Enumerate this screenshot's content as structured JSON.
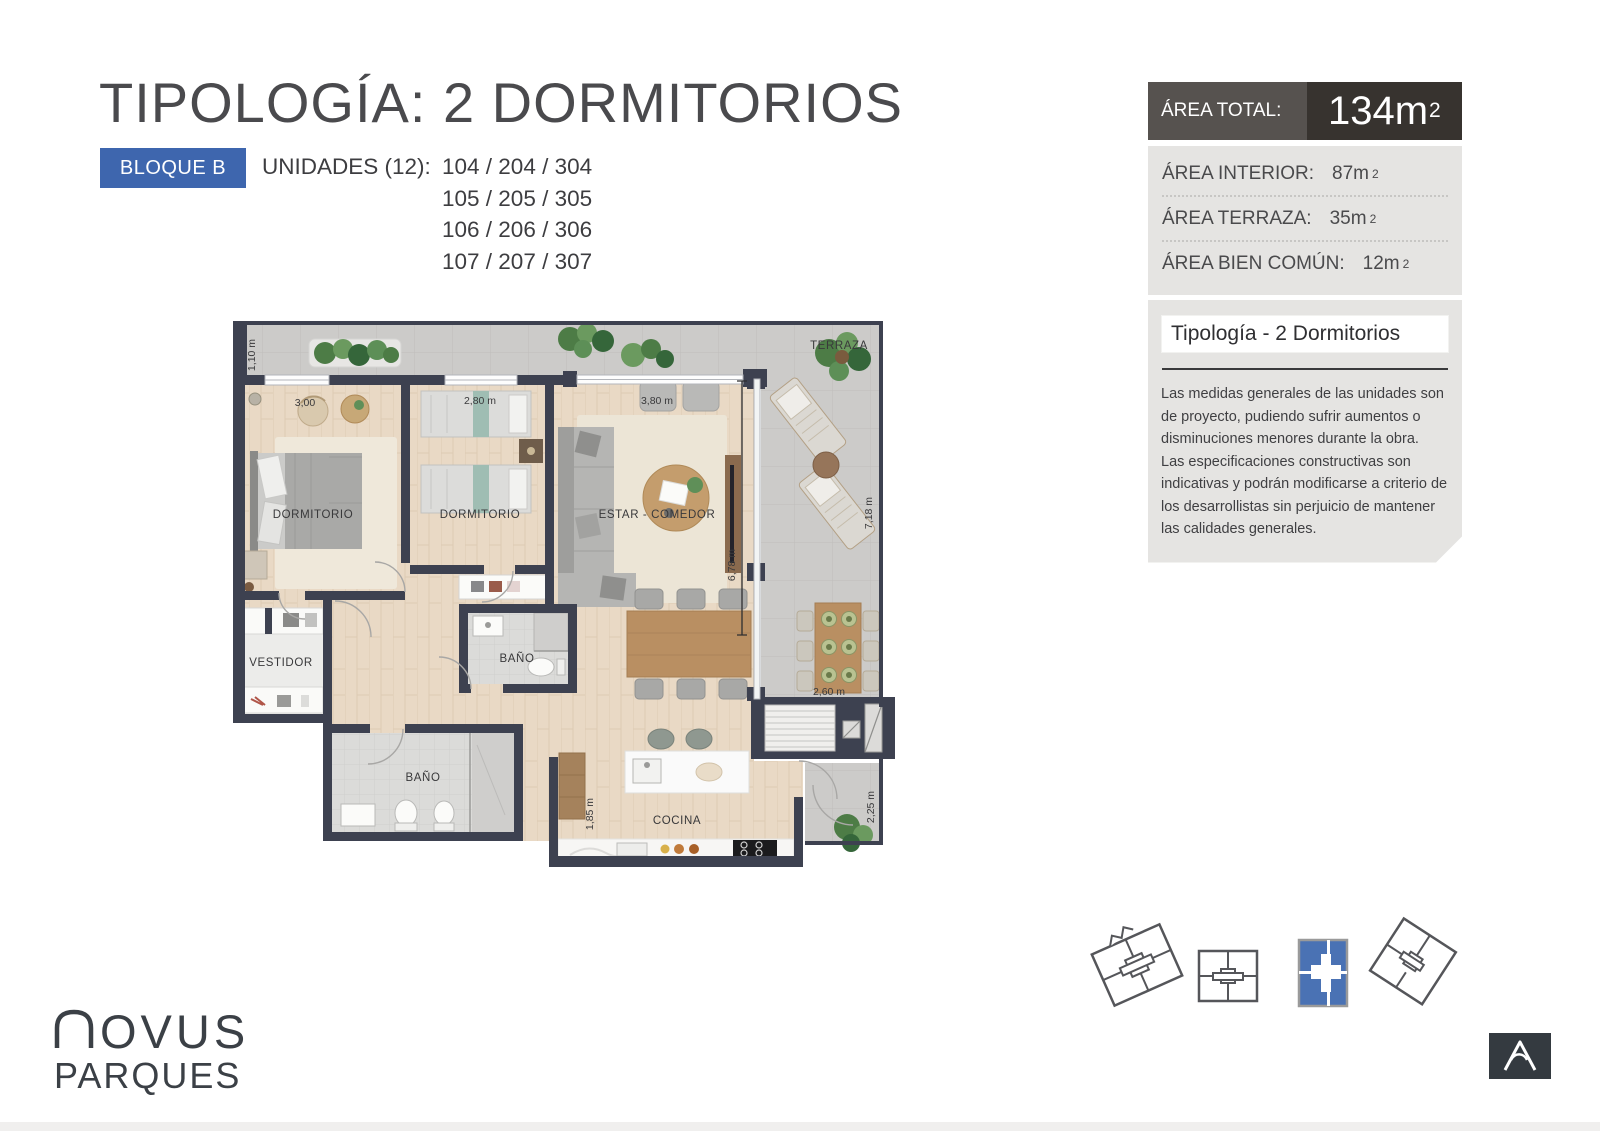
{
  "header": {
    "title": "TIPOLOGÍA: 2 DORMITORIOS",
    "block_badge": "BLOQUE B",
    "units_label": "UNIDADES (12):",
    "units_lines": [
      "104 / 204 / 304",
      "105 / 205 / 305",
      "106 / 206 / 306",
      "107 / 207 / 307"
    ]
  },
  "area_panel": {
    "total_label": "ÁREA TOTAL:",
    "total_value": "134m",
    "total_sup": "2",
    "rows": [
      {
        "label": "ÁREA INTERIOR:",
        "value": "87m",
        "sup": "2"
      },
      {
        "label": "ÁREA TERRAZA:",
        "value": "35m",
        "sup": "2"
      },
      {
        "label": "ÁREA BIEN COMÚN:",
        "value": "12m",
        "sup": "2"
      }
    ],
    "colors": {
      "header_left_bg": "#56524f",
      "header_right_bg": "#37332f",
      "body_bg": "#e5e4e2"
    }
  },
  "info_box": {
    "title": "Tipología - 2 Dormitorios",
    "paragraph1": "Las medidas generales de las unidades son de proyecto, pudiendo sufrir aumentos o disminuciones menores durante la obra.",
    "paragraph2": "Las especificaciones constructivas son indicativas y podrán modificarse a criterio de los desarrollistas sin perjuicio de mantener las calidades generales."
  },
  "floorplan": {
    "rooms": {
      "terraza": "TERRAZA",
      "dormitorio_1": "DORMITORIO",
      "dormitorio_2": "DORMITORIO",
      "estar_comedor": "ESTAR - COMEDOR",
      "vestidor": "VESTIDOR",
      "bano_1": "BAÑO",
      "bano_2": "BAÑO",
      "cocina": "COCINA"
    },
    "dimensions": {
      "terrace_left": "1,10 m",
      "dorm1_width": "3,00",
      "dorm2_width": "2,80 m",
      "estar_width": "3,80 m",
      "terrace_right_height": "7,18 m",
      "estar_height": "6,78 m",
      "terrace_bottom_width": "2,60 m",
      "kitchen_height": "1,85 m",
      "terrace_lower_height": "2,25 m"
    },
    "colors": {
      "wall": "#3d4150",
      "wood_floor": "#e9d9c5",
      "terrace_tile": "#cccbc9"
    }
  },
  "block_selector": {
    "icons": [
      "bloque-outline-rotated-left",
      "bloque-outline-upright",
      "bloque-selected-blue",
      "bloque-outline-rotated-right"
    ],
    "selected_color": "#4a72b4"
  },
  "brand": {
    "wordmark_rest": "OVUS",
    "wordmark_line2": "PARQUES"
  }
}
